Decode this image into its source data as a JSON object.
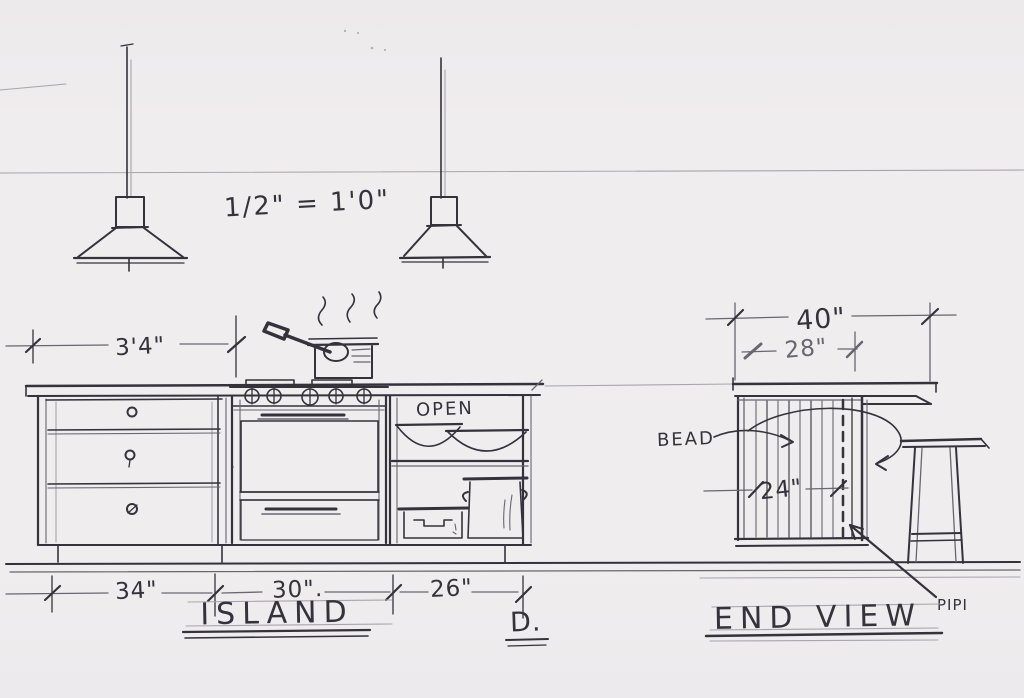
{
  "colors": {
    "paper": "#f0edef",
    "pencil": "#35323b",
    "pencil_mid": "#6a6570",
    "pencil_light": "#aaa3ab"
  },
  "drawing": {
    "scale_note": "1/2\" = 1'0\"",
    "island": {
      "title": "ISLAND",
      "detail_ref": "D.",
      "shelf_label": "OPEN",
      "dims": {
        "counter_left": "3'4\"",
        "drawers": "34\"",
        "range": "30\".",
        "shelves": "26\""
      }
    },
    "end_view": {
      "title": "END VIEW",
      "bead_label": "BEAD",
      "pipe_label": "PIPI",
      "dims": {
        "overall": "40\"",
        "counter": "28\"",
        "panel": "24\""
      }
    }
  }
}
